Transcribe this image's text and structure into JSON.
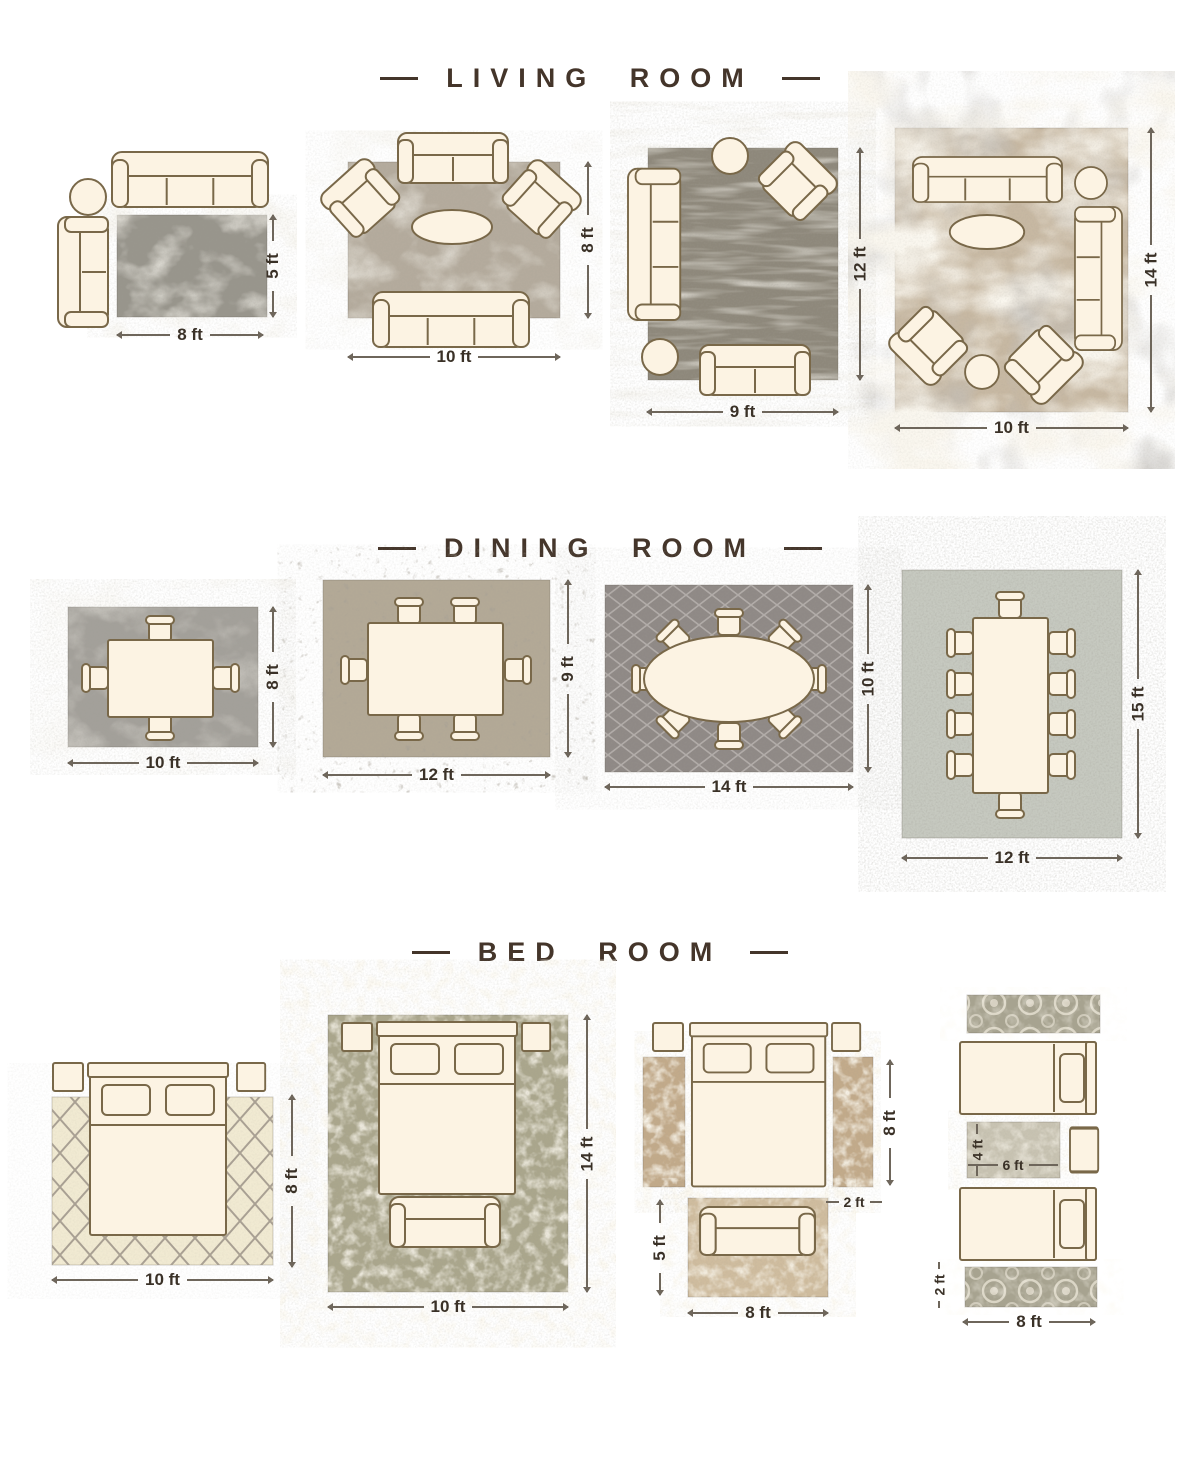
{
  "page": {
    "kind": "rug-size-guide-infographic",
    "background": "#ffffff",
    "title_color": "#44352a",
    "dimension_label_color": "#3a3127",
    "furniture_fill": "#FCF3E3",
    "furniture_outline": "#796849"
  },
  "sections": [
    {
      "title": "LIVING ROOM",
      "layouts": [
        {
          "name": "two-sofas-side-table",
          "width_label": "8 ft",
          "height_label": "5 ft",
          "rug_color": "#98958c"
        },
        {
          "name": "sofa-loveseat-two-armchairs",
          "width_label": "10 ft",
          "height_label": "8 ft",
          "rug_color": "#b4ab9d"
        },
        {
          "name": "sofa-loveseat-armchair",
          "width_label": "9 ft",
          "height_label": "12 ft",
          "rug_color": "#8e887b"
        },
        {
          "name": "two-sofas-two-armchairs",
          "width_label": "10 ft",
          "height_label": "14 ft",
          "rug_color": "#c7b8a2"
        }
      ]
    },
    {
      "title": "DINING ROOM",
      "layouts": [
        {
          "name": "table-four-chairs",
          "width_label": "10 ft",
          "height_label": "8 ft",
          "rug_color": "#a3a09a"
        },
        {
          "name": "table-six-chairs",
          "width_label": "12 ft",
          "height_label": "9 ft",
          "rug_color": "#b3a996"
        },
        {
          "name": "oval-table-eight-chairs",
          "width_label": "14 ft",
          "height_label": "10 ft",
          "rug_color": "#8f8986"
        },
        {
          "name": "long-table-ten-chairs",
          "width_label": "12 ft",
          "height_label": "15 ft",
          "rug_color": "#c6c9c0"
        }
      ]
    },
    {
      "title": "BED ROOM",
      "layouts": [
        {
          "name": "bed-partial-on-rug",
          "width_label": "10 ft",
          "height_label": "8 ft",
          "rug_color": "#f1ead2"
        },
        {
          "name": "bed-and-bench-on-rug",
          "width_label": "10 ft",
          "height_label": "14 ft",
          "rug_color": "#aaa68c"
        },
        {
          "name": "bed-with-side-runners-and-foot-rug",
          "runner_height_label": "8 ft",
          "runner_width_label": "2 ft",
          "foot_rug_height_label": "5 ft",
          "foot_rug_width_label": "8 ft",
          "runner_color": "#c2aa8a",
          "foot_rug_color": "#cfbc9e"
        },
        {
          "name": "twin-beds-with-runners-and-center-rug",
          "center_rug_height_label": "4 ft",
          "center_rug_width_label": "6 ft",
          "runner_height_label": "2 ft",
          "runner_width_label": "8 ft",
          "runner_color": "#a7a390",
          "center_rug_color": "#c8c3b2"
        }
      ]
    }
  ]
}
